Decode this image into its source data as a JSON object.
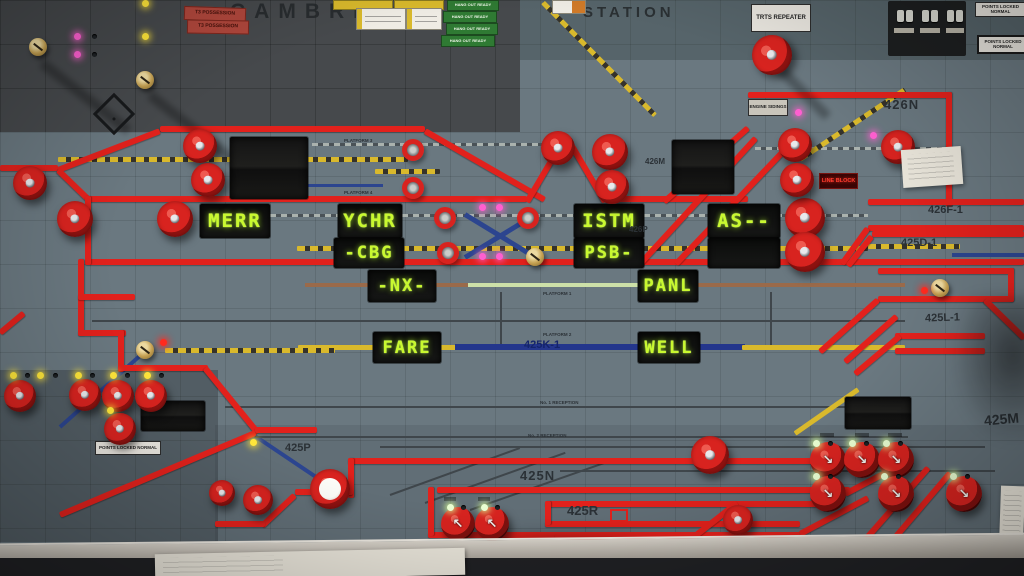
{
  "header": {
    "station_name_left": "CAMBRIDGE",
    "station_name_right": "STATION",
    "possession_labels": [
      "T3 POSSESSION",
      "T3 POSSESSION"
    ],
    "hang_out_ready_labels": [
      "HANG OUT READY",
      "HANG OUT READY",
      "HANG OUT READY",
      "HANG OUT READY"
    ],
    "trts_repeater": "TRTS REPEATER",
    "points_locked_normal_labels": [
      "POINTS LOCKED NORMAL",
      "POINTS LOCKED NORMAL"
    ]
  },
  "train_describers": {
    "merr": "MERR",
    "ychr": "YCHR",
    "cbg": "-CBG",
    "istm": "ISTM",
    "as_code": "AS--",
    "psb": "PSB-",
    "nx": "-NX-",
    "panl": "PANL",
    "fare": "FARE",
    "well": "WELL"
  },
  "track_labels": {
    "engine_sidings": "ENGINE SIDINGS",
    "siding_426n": "426N",
    "line_block": "LINE BLOCK",
    "route_426m": "426M",
    "route_426f1": "426F-1",
    "route_425d1": "425D-1",
    "route_426p": "426P",
    "route_425l1": "425L-1",
    "route_425k1": "425K-1",
    "route_425p": "425P",
    "route_425n": "425N",
    "route_425r": "425R",
    "route_425m": "425M",
    "platform_1": "PLATFORM 1",
    "platform_2": "PLATFORM 2",
    "platform_3": "PLATFORM 3",
    "platform_4": "PLATFORM 4",
    "reception_1": "No. 1 RECEPTION",
    "reception_2": "No. 2 RECEPTION"
  },
  "bottom_labels": {
    "points_locked_normal": "POINTS LOCKED NORMAL"
  },
  "colors": {
    "track_red": "#e2211c",
    "led_text_green": "#c9f92f",
    "led_yellow": "#ffe63a",
    "led_magenta": "#ff5fd0",
    "led_red": "#ff2a1e",
    "panel_grey_blue": "#6a7880",
    "panel_dark_grey": "#46494c",
    "knob_red": "#d8231f",
    "hang_out_green": "#2f7a33",
    "possession_red": "#b0473c"
  }
}
